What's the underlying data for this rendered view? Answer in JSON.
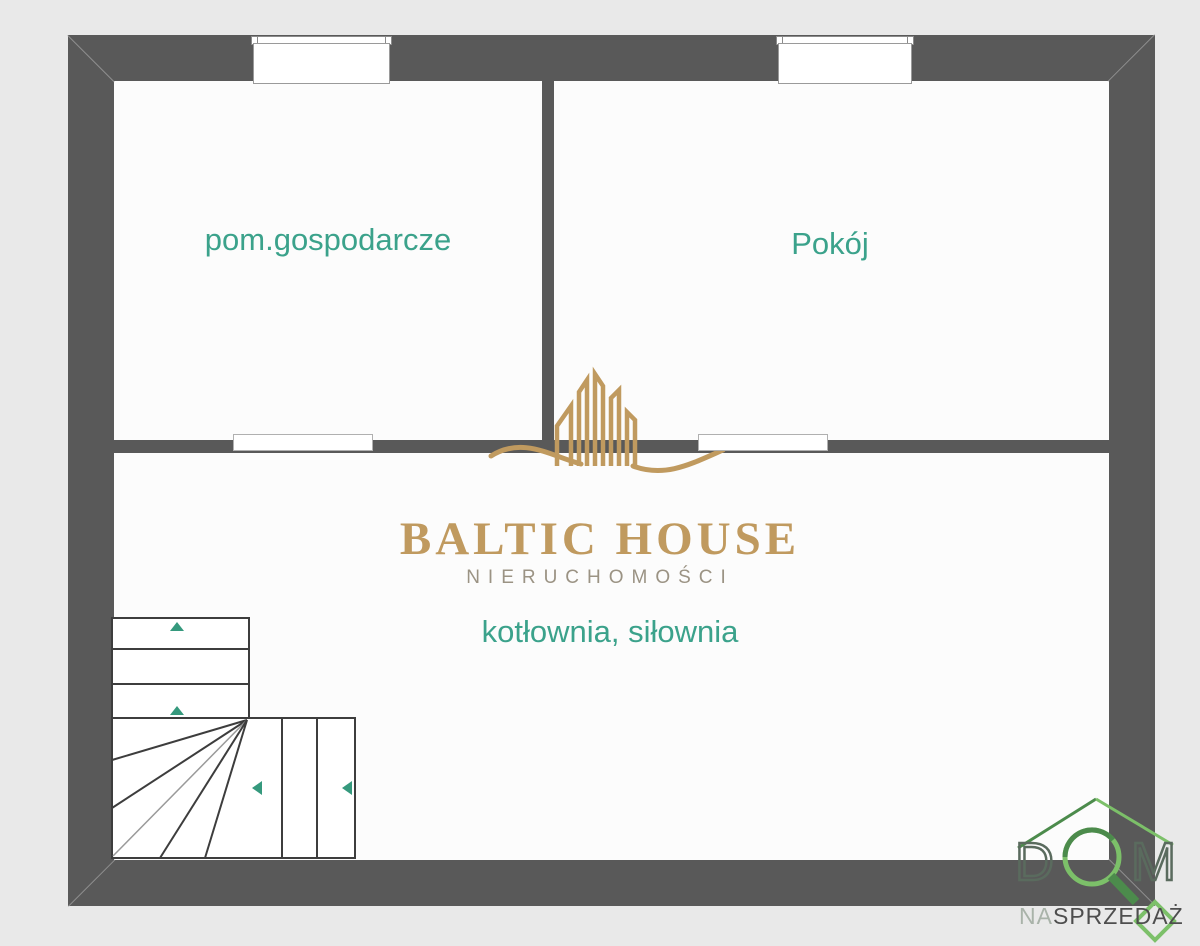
{
  "plan": {
    "rooms": [
      {
        "label": "pom.gospodarcze"
      },
      {
        "label": "Pokój"
      },
      {
        "label": "kotłownia, siłownia"
      }
    ]
  },
  "watermark": {
    "brand": "BALTIC HOUSE",
    "tagline": "NIERUCHOMOŚCI"
  },
  "corner_logo": {
    "letter_d": "D",
    "letter_m": "M",
    "tagline_na": "NA",
    "tagline_sprzedaz": "SPRZEDAŻ"
  },
  "colors": {
    "wall": "#595959",
    "bg": "#e9e9e9",
    "floor": "#fcfcfc",
    "label_teal": "#3ba28b",
    "arrow_teal": "#35997d",
    "stair_line": "#3d3d3d",
    "gold": "#c09a5f",
    "subtitle_gray": "#9b9384",
    "logo_green_dark": "#4c8b4c",
    "logo_green_light": "#7cc069",
    "logo_text_dark": "#4e4e4e",
    "logo_text_light": "#a9b3a9"
  }
}
